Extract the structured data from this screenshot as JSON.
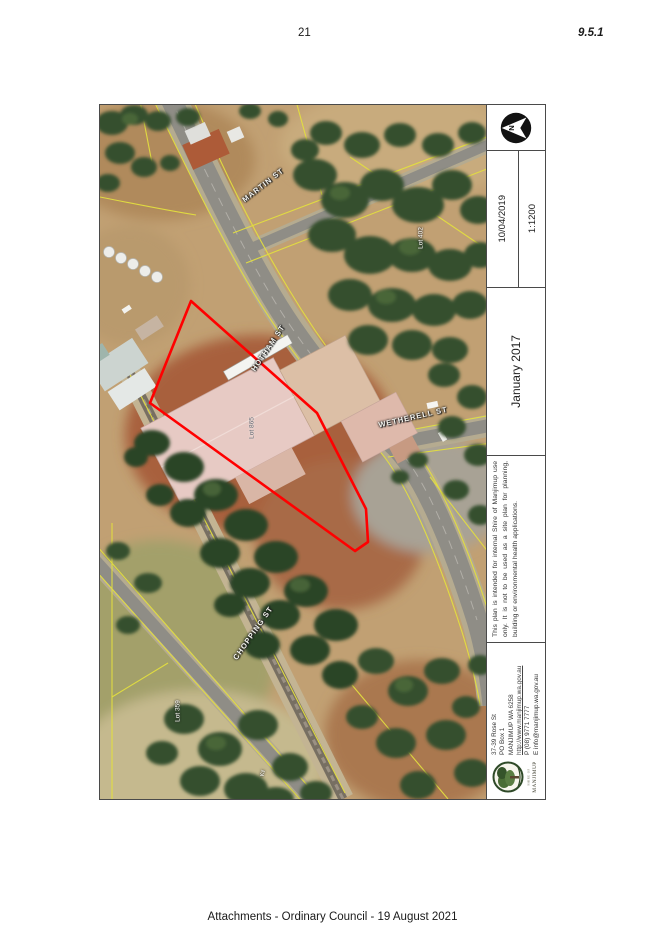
{
  "page": {
    "page_number": "21",
    "section_ref": "9.5.1",
    "footer": "Attachments - Ordinary Council - 19 August 2021"
  },
  "map": {
    "street_labels": [
      {
        "text": "MARTIN ST"
      },
      {
        "text": "HOTHAM ST"
      },
      {
        "text": "WETHERELL ST"
      },
      {
        "text": "CHOPPING ST"
      }
    ],
    "lot_labels": [
      {
        "text": "Lot 402"
      },
      {
        "text": "Lot 865"
      },
      {
        "text": "Lot 359"
      },
      {
        "text": "Ky"
      }
    ],
    "highlight_color": "#ff0000"
  },
  "titleblock": {
    "north_label": "N",
    "date": "10/04/2019",
    "scale": "1:1200",
    "plan_date": "January 2017",
    "disclaimer": "This plan is intended for internal Shire of Manjimup use only. It is not to be used as a site plan for planning, building or environmental health applications.",
    "contact": {
      "address_line1": "37-39 Rose St",
      "address_line2": "PO Box 1",
      "address_line3": "MANJIMUP WA 6258",
      "website": "http://www.manjimup.wa.gov.au",
      "phone": "P (08) 9771 7777",
      "email": "E info@manjimup.wa.gov.au",
      "logo_top": "SHIRE OF",
      "logo_name": "MANJIMUP"
    }
  }
}
